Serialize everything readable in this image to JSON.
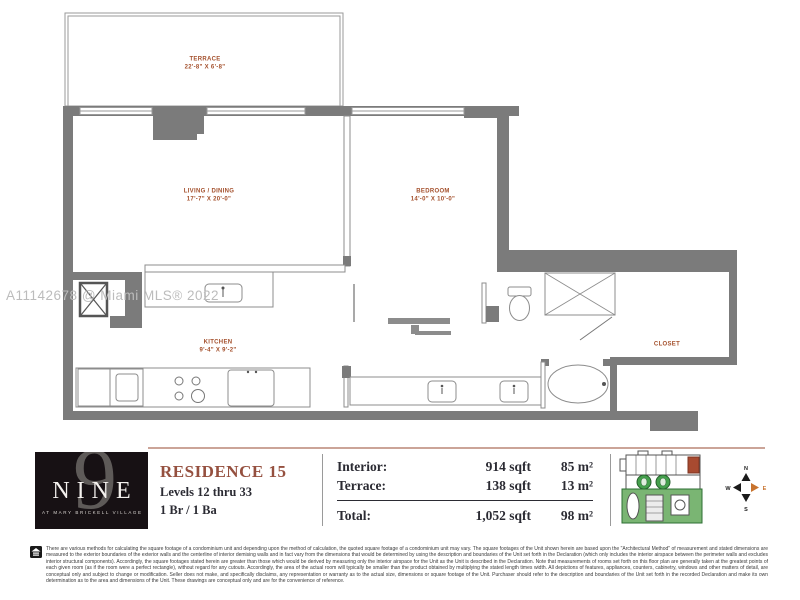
{
  "watermark": "A11142678 @ Miami MLS® 2022",
  "plan": {
    "terrace": {
      "name": "TERRACE",
      "dims": "22'-8\" X 6'-8\""
    },
    "living": {
      "name": "LIVING / DINING",
      "dims": "17'-7\" X 20'-0\""
    },
    "bedroom": {
      "name": "BEDROOM",
      "dims": "14'-0\" X 10'-0\""
    },
    "kitchen": {
      "name": "KITCHEN",
      "dims": "9'-4\" X 9'-2\""
    },
    "closet": {
      "name": "CLOSET"
    }
  },
  "info": {
    "logo": {
      "numeral": "9",
      "brand": "NINE",
      "tagline": "AT MARY BRICKELL VILLAGE"
    },
    "residence": {
      "title": "RESIDENCE 15",
      "levels": "Levels 12 thru 33",
      "beds_baths": "1 Br / 1 Ba"
    },
    "areas": {
      "rows": [
        {
          "label": "Interior:",
          "sqft": "914 sqft",
          "sqm": "85 m²"
        },
        {
          "label": "Terrace:",
          "sqft": "138 sqft",
          "sqm": "13 m²"
        }
      ],
      "total": {
        "label": "Total:",
        "sqft": "1,052 sqft",
        "sqm": "98 m²"
      }
    },
    "compass": {
      "north": "N",
      "south": "S",
      "east": "E",
      "west": "W"
    }
  },
  "colors": {
    "wall_gray": "#7b7b7b",
    "label_brown": "#a4502c",
    "accent_brick": "#95503f",
    "keyplan_green": "#44a04c",
    "keyplan_highlight_unit": "#a84a30",
    "compass_east_orange": "#c8732e"
  },
  "disclaimer": "There are various methods for calculating the square footage of a condominium unit and depending upon the method of calculation, the quoted square footage of a condominium unit may vary. The square footages of the Unit shown herein are based upon the \"Architectural Method\" of measurement and stated dimensions are measured to the exterior boundaries of the exterior walls and the centerline of interior demising walls and in fact vary from the dimensions that would be determined by using the description and boundaries of the Unit set forth in the Declaration (which only includes the interior airspace between the perimeter walls and excludes interior structural components). Accordingly, the square footages stated herein are greater than those which would be derived by measuring only the interior airspace for the Unit as the Unit is described in the Declaration. Note that measurements of rooms set forth on this floor plan are generally taken at the greatest points of each given room (as if the room were a perfect rectangle), without regard for any cutouts. Accordingly, the area of the actual room will typically be smaller than the product obtained by multiplying the stated length times width. All depictions of features, appliances, counters, cabinetry, windows and other matters of detail, are conceptual only and subject to change or modification. Seller does not make, and specifically disclaims, any representation or warranty as to the actual size, dimensions or square footage of the Unit. Purchaser should refer to the description and boundaries of the Unit set forth in the recorded Declaration and make its own determination as to the area and dimensions of the Unit. These drawings are conceptual only and are for the convenience of reference."
}
